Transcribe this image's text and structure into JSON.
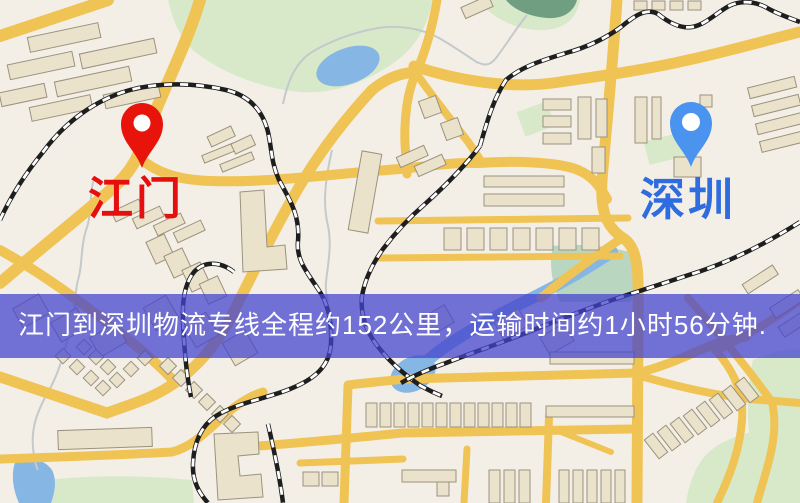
{
  "markers": [
    {
      "id": "origin",
      "city": "江门",
      "icon": "location-pin-icon",
      "pin_color": "#e8130a",
      "label_color": "#e60f0f"
    },
    {
      "id": "destination",
      "city": "深圳",
      "icon": "location-pin-icon",
      "pin_color": "#4a93ee",
      "label_color": "#2e6ce0"
    }
  ],
  "banner": {
    "text": "江门到深圳物流专线全程约152公里，运输时间约1小时56分钟.",
    "route": {
      "origin": "江门",
      "destination": "深圳",
      "distance": "约152公里",
      "duration": "约1小时56分钟"
    },
    "background_color": "#4343cd",
    "text_color": "#ffffff"
  },
  "theme": {
    "background": "#f4efe6",
    "road": "#f0c355",
    "water": "#86b6e4",
    "park": "#d8e9ca",
    "building": "#eae2cb",
    "building_stroke": "#9b927d",
    "railway": "#1e1e1e",
    "stream": "#c4c9cc"
  }
}
